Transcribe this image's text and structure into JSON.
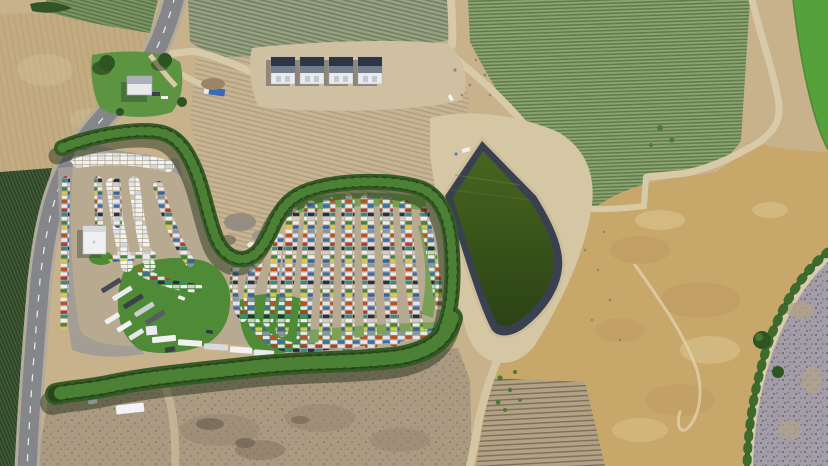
{
  "scene": {
    "type": "aerial-drone-photograph",
    "description": "Overhead drone view of a rural auto salvage yard. A serpentine windbreak of poplar trees wraps around hundreds of colorful junked cars parked in curved rows. A two-lane highway runs down the left edge past a sales lot with a white office building, RVs and semi trailers. Vineyard blocks with striped crop rows fill the top, four dark-roofed warehouse buildings sit on a dirt pad, a dark-green lined irrigation pond sits center-right, and dry golden rangeland with a curving canal occupies the right and bottom.",
    "regions": {
      "highway": "two-lane rural highway, left edge",
      "sales_lot": "gray parking lot with office and truck rows",
      "salvage_yard": "curved rows of junk cars inside tree ring",
      "tree_windbreak": "S-shaped poplar tree line with cast shadows",
      "warehouses": "four matching dark-roof storage buildings",
      "irrigation_pond": "black-lined pond with dark green water",
      "vineyards": "row-crop blocks at top of frame",
      "golden_field": "dry tan rangeland, right side",
      "canal": "tree-dotted canal curving through lower right",
      "plowed_field": "fallow striped dirt field in central valley",
      "bottom_field": "scrubby brown field with debris, bottom center"
    },
    "vehicle_estimate": "600+ vehicles",
    "time_of_day": "midday, sun from the northeast"
  },
  "palette": {
    "dirt": "#c7b28c",
    "dirtLight": "#d5c6a4",
    "gravel": "#b7aa90",
    "asphalt": "#85868a",
    "shoulder": "#b3ab9b",
    "lot": "#a29e96",
    "lane": "#b6ad9c",
    "cropDark": "#3f5a35",
    "vineyard": "#8fa271",
    "vineyardPale": "#9aa084",
    "grassBright": "#55a13a",
    "lawn": "#4f8a37",
    "lawnLight": "#6a9e4a",
    "treeDark": "#365c26",
    "treeLight": "#4c8034",
    "treeDeep": "#23431a",
    "pondLiner": "#394150",
    "golden": "#c8a76a",
    "scrub": "#a39da8",
    "plowed": "#c6b493",
    "bottomField": "#ab9a82",
    "white": "#eef0f2",
    "roofDark": "#2c3446"
  }
}
